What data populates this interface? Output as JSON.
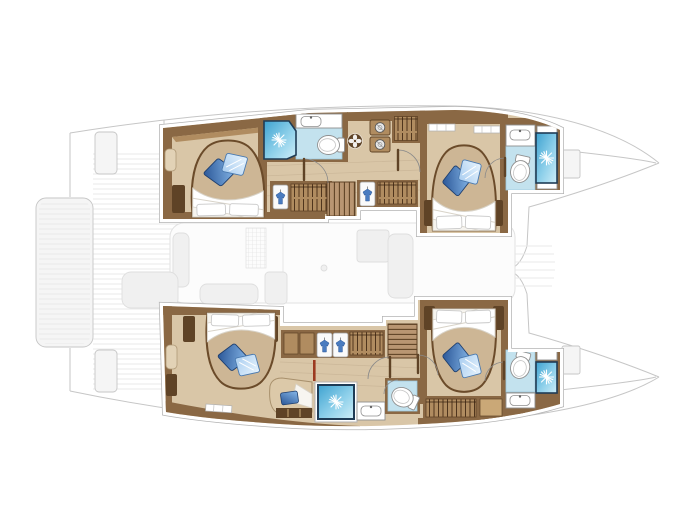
{
  "canvas": {
    "width": 700,
    "height": 524,
    "background": "#ffffff"
  },
  "figure": {
    "kind": "catamaran-interior-deck-plan",
    "view": "top-down",
    "orientation": "bows-right",
    "rendering": "colored hull interiors over faded deck outline"
  },
  "colors": {
    "canvas_bg": "#ffffff",
    "ghost_line": "#c6c6c6",
    "ghost_fill": "#f5f5f5",
    "ghost_furn": "#f0f0f0",
    "ghost_edge": "#dedede",
    "ghost_stripe": "#e9e9e9",
    "floor": "#d9c6a7",
    "wood": "#8a6844",
    "wood_dark": "#5f4326",
    "wood_light": "#b08c60",
    "wood_pale": "#caa877",
    "bed_base": "#cdb695",
    "bed_edge": "#6b4b2a",
    "duvet_line": "#d8d3c8",
    "pillow_line": "#c9c9c9",
    "cushion_dark_a": "#2a5697",
    "cushion_dark_b": "#86b7e8",
    "cushion_light_a": "#a9cdf0",
    "cushion_light_b": "#e8f4fd",
    "shower_a": "#3ea2d0",
    "shower_b": "#8ed0ea",
    "shower_c": "#cfeef8",
    "shower_frame": "#1f3c56",
    "bath_floor": "#c3e2ee",
    "bath_edge": "#9fcade",
    "fixture_line": "#909090",
    "fixture_soft": "#c4c4c4",
    "boundary_gray": "#b3b3b3",
    "plant": "#7aa34f",
    "accent_red": "#9c3a20"
  },
  "inventory": {
    "hulls": [
      {
        "id": "port-hull",
        "position": "top",
        "rooms": [
          "aft-cabin",
          "mid-bathroom",
          "corridor-wardrobes",
          "stairs",
          "forward-cabin",
          "forward-bathroom"
        ]
      },
      {
        "id": "starboard-hull",
        "position": "bottom",
        "rooms": [
          "aft-cabin",
          "aft-shower",
          "aft-toilet-room",
          "corridor-wardrobes",
          "stairs",
          "forward-cabin",
          "forward-bathroom"
        ]
      }
    ],
    "counts": {
      "double-beds": 4,
      "showers": 4,
      "toilets": 4,
      "sinks": 4,
      "staircases": 2,
      "washer-dryer-units": 2
    },
    "ghost_elements": [
      "deck-outline",
      "port-bow",
      "starboard-bow",
      "aft-swim-platform",
      "transom-decking",
      "cockpit-furniture",
      "salon-furniture",
      "foredeck"
    ]
  }
}
